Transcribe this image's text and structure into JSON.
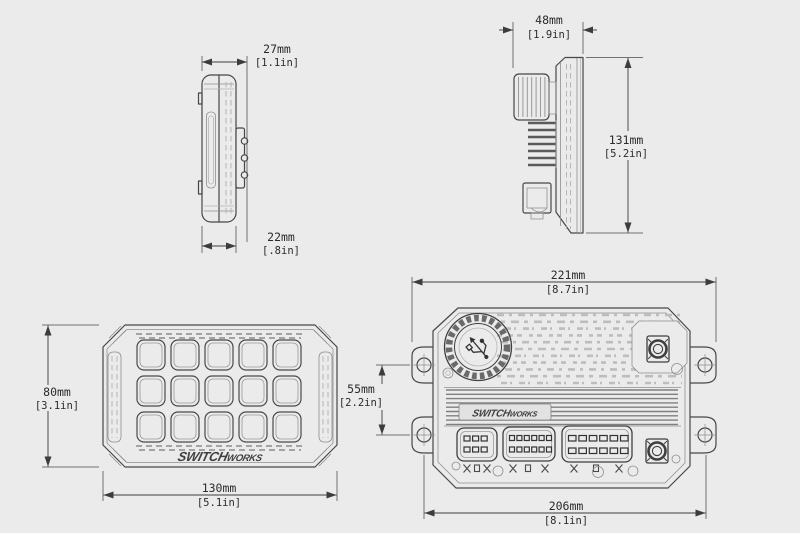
{
  "drawing": {
    "background": "#ebebeb",
    "line_color": "#474747",
    "dim_color": "#2b2b2b",
    "brand": {
      "part1": "SWITCH",
      "part2": "WORKS"
    },
    "icons": {
      "knob_symbol": "usb-icon",
      "mount_hole": "crosshair-hole-icon"
    },
    "dims": {
      "keypad_depth_overall": {
        "mm": "27mm",
        "in": "[1.1in]"
      },
      "keypad_body_depth": {
        "mm": "22mm",
        "in": "[.8in]"
      },
      "controller_depth": {
        "mm": "48mm",
        "in": "[1.9in]"
      },
      "controller_height": {
        "mm": "131mm",
        "in": "[5.2in]"
      },
      "keypad_height": {
        "mm": "80mm",
        "in": "[3.1in]"
      },
      "keypad_width": {
        "mm": "130mm",
        "in": "[5.1in]"
      },
      "controller_width": {
        "mm": "221mm",
        "in": "[8.7in]"
      },
      "controller_mount_v": {
        "mm": "55mm",
        "in": "[2.2in]"
      },
      "controller_mount_h": {
        "mm": "206mm",
        "in": "[8.1in]"
      }
    },
    "keypad": {
      "button_rows": 3,
      "button_cols": 5
    },
    "connectors": [
      {
        "rows": 2,
        "pins": 3
      },
      {
        "rows": 2,
        "pins": 6
      },
      {
        "rows": 2,
        "pins": 6
      }
    ]
  }
}
